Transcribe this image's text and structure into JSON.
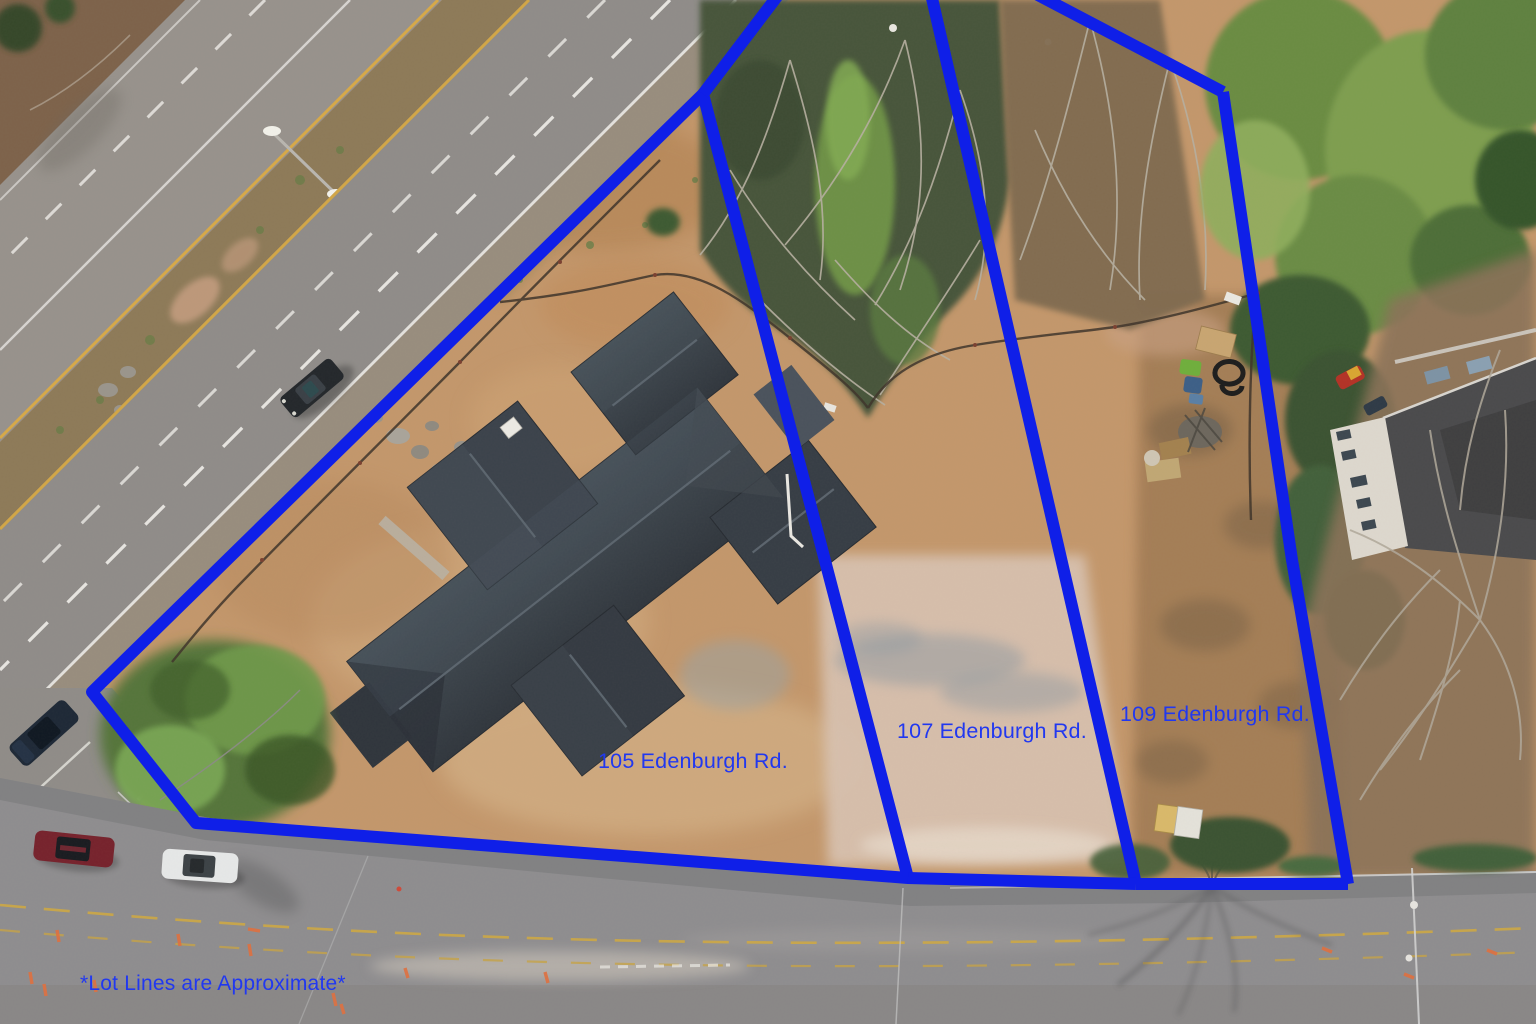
{
  "annotations": {
    "lots": [
      {
        "label": "105 Edenburgh Rd."
      },
      {
        "label": "107 Edenburgh Rd."
      },
      {
        "label": "109 Edenburgh Rd."
      }
    ],
    "disclaimer": "*Lot Lines are Approximate*",
    "line_color": "#0f1fe8",
    "label_color": "#2138f0"
  }
}
